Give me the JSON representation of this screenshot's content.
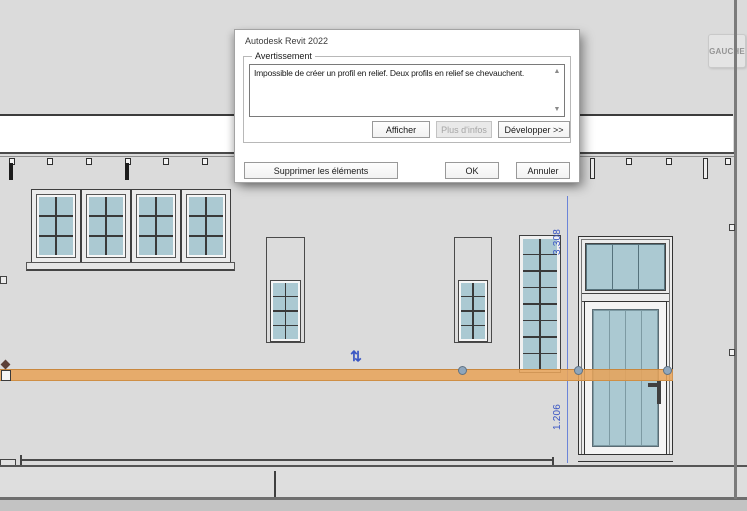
{
  "dialog": {
    "title": "Autodesk Revit 2022",
    "group_label": "Avertissement",
    "message": "Impossible de créer un profil en relief. Deux profils en relief se chevauchent.",
    "buttons": {
      "afficher": "Afficher",
      "plus_infos": "Plus d'infos",
      "developper": "Développer >>",
      "supprimer": "Supprimer les éléments",
      "ok": "OK",
      "annuler": "Annuler"
    },
    "scrollbar": {
      "up": "▲",
      "down": "▼"
    }
  },
  "view": {
    "tag_label": "GAUCHE",
    "dimensions": {
      "upper": "3.308",
      "lower": "1.206"
    },
    "flip_glyph": "⇅",
    "colors": {
      "sweep_orange": "#E7A35A",
      "glass_blue": "#ABC9D2",
      "dimension_blue": "#3A56C4",
      "background_gray": "#DBDBDB"
    }
  }
}
